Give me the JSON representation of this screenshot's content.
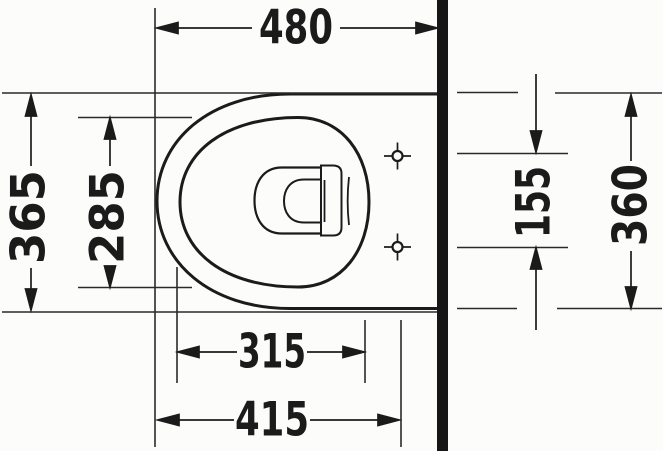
{
  "drawing": {
    "type": "technical-plan-view",
    "subject": "wall-hung toilet, top view with installation dimensions",
    "colors": {
      "ink": "#1b1b1b",
      "background": "#fcfdfb"
    },
    "dimensions": {
      "top_480": {
        "label": "480"
      },
      "left_365": {
        "label": "365"
      },
      "left_285": {
        "label": "285"
      },
      "right_155": {
        "label": "155"
      },
      "right_360": {
        "label": "360"
      },
      "bottom_315": {
        "label": "315"
      },
      "bottom_415": {
        "label": "415"
      }
    }
  }
}
